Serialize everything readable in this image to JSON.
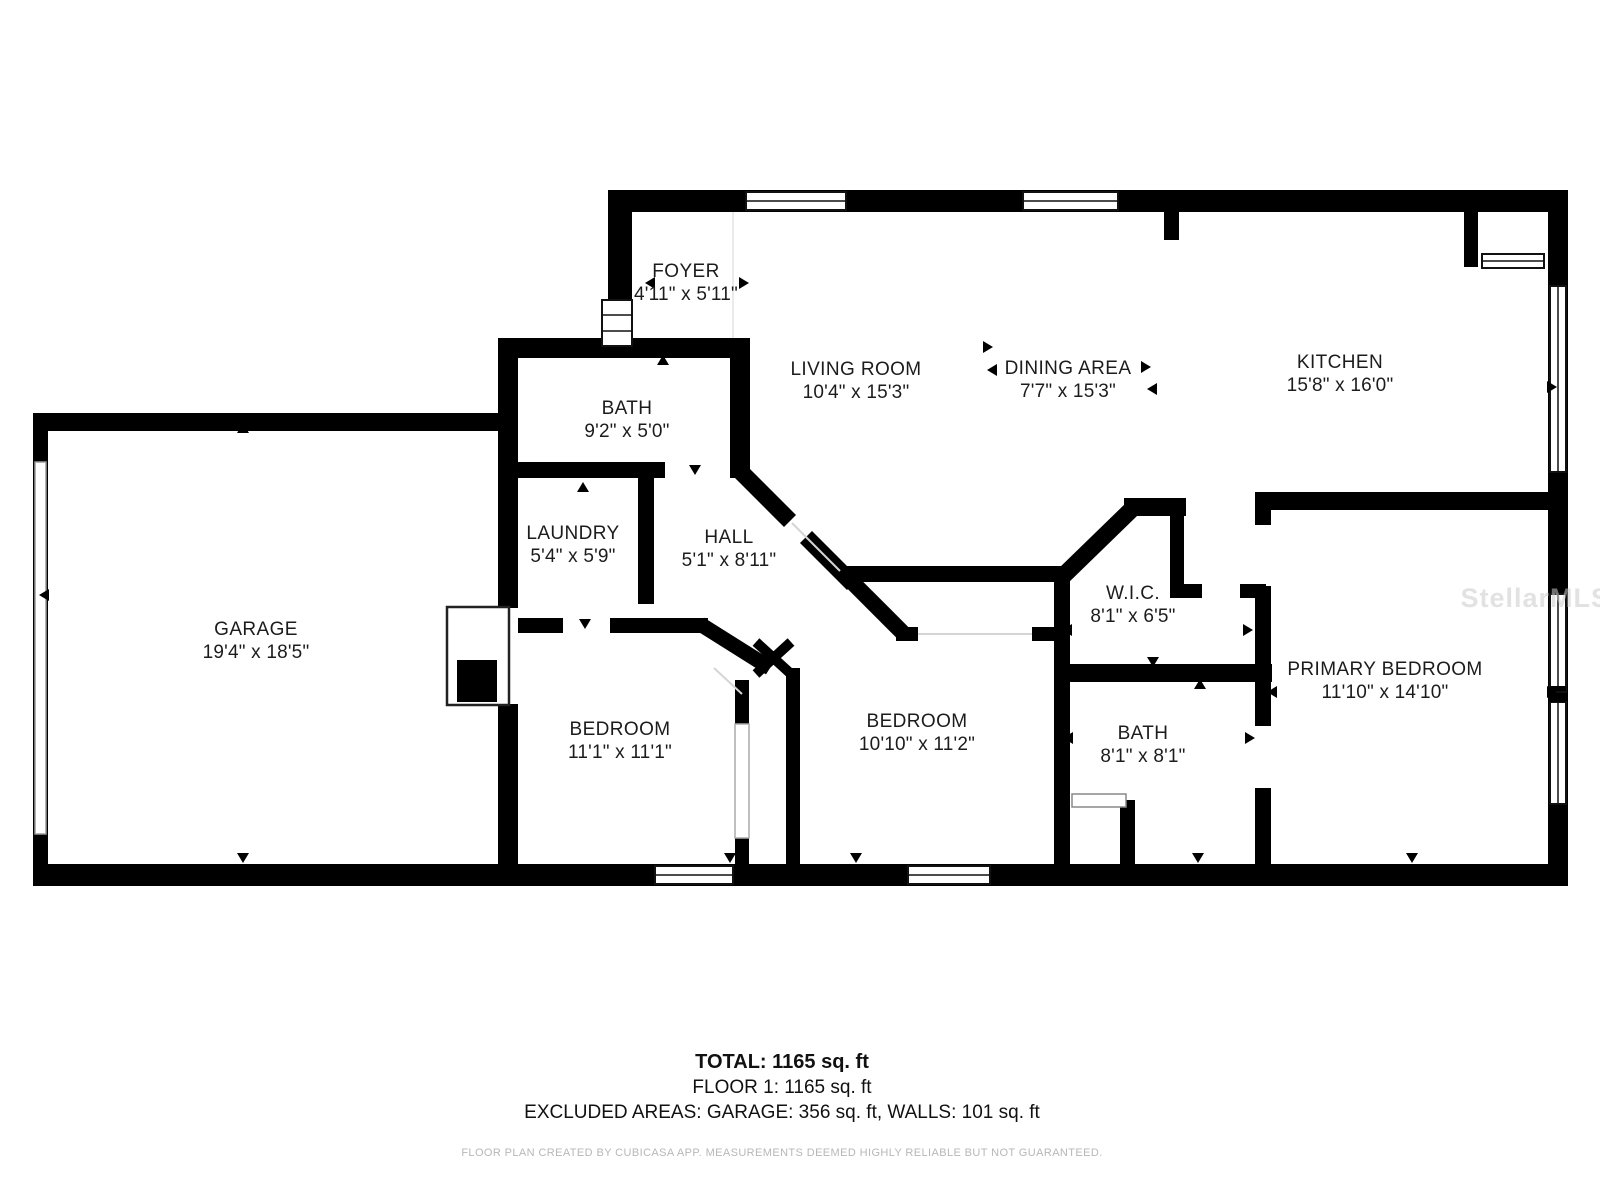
{
  "plan_title": "floor-plan",
  "watermark": "StellarMLS",
  "colors": {
    "wall": "#000000",
    "label_text": "#1c1c1c",
    "disclaimer_text": "#b7b7b7",
    "watermark_text": "#cccccc"
  },
  "rooms": [
    {
      "id": "foyer",
      "name": "FOYER",
      "dims": "4'11\" x 5'11\"",
      "x": 686,
      "y": 283
    },
    {
      "id": "bath-upper",
      "name": "BATH",
      "dims": "9'2\" x 5'0\"",
      "x": 627,
      "y": 420
    },
    {
      "id": "living-room",
      "name": "LIVING ROOM",
      "dims": "10'4\" x 15'3\"",
      "x": 856,
      "y": 381
    },
    {
      "id": "dining-area",
      "name": "DINING AREA",
      "dims": "7'7\" x 15'3\"",
      "x": 1068,
      "y": 380
    },
    {
      "id": "kitchen",
      "name": "KITCHEN",
      "dims": "15'8\" x 16'0\"",
      "x": 1340,
      "y": 374
    },
    {
      "id": "garage",
      "name": "GARAGE",
      "dims": "19'4\" x 18'5\"",
      "x": 256,
      "y": 641
    },
    {
      "id": "laundry",
      "name": "LAUNDRY",
      "dims": "5'4\" x 5'9\"",
      "x": 573,
      "y": 545
    },
    {
      "id": "hall",
      "name": "HALL",
      "dims": "5'1\" x 8'11\"",
      "x": 729,
      "y": 549
    },
    {
      "id": "wic",
      "name": "W.I.C.",
      "dims": "8'1\" x 6'5\"",
      "x": 1133,
      "y": 605
    },
    {
      "id": "bedroom-left",
      "name": "BEDROOM",
      "dims": "11'1\" x 11'1\"",
      "x": 620,
      "y": 741
    },
    {
      "id": "bedroom-middle",
      "name": "BEDROOM",
      "dims": "10'10\" x 11'2\"",
      "x": 917,
      "y": 733
    },
    {
      "id": "bath-primary",
      "name": "BATH",
      "dims": "8'1\" x 8'1\"",
      "x": 1143,
      "y": 745
    },
    {
      "id": "primary-bedroom",
      "name": "PRIMARY BEDROOM",
      "dims": "11'10\" x 14'10\"",
      "x": 1385,
      "y": 681
    }
  ],
  "footer": {
    "total": "TOTAL: 1165 sq. ft",
    "floor": "FLOOR 1: 1165 sq. ft",
    "excluded": "EXCLUDED AREAS: GARAGE: 356 sq. ft, WALLS: 101 sq. ft",
    "disclaimer": "FLOOR PLAN CREATED BY CUBICASA APP. MEASUREMENTS DEEMED HIGHLY RELIABLE BUT NOT GUARANTEED."
  }
}
